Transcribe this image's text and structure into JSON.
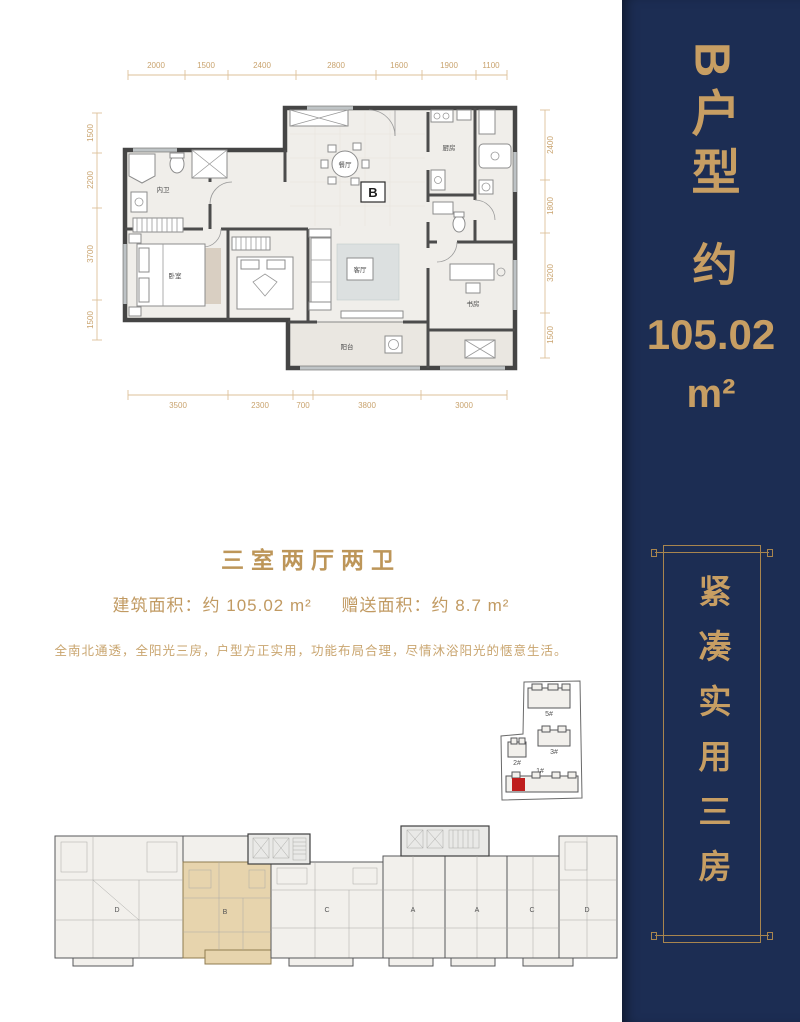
{
  "banner": {
    "line1": "B户型",
    "line2": "约",
    "area_value": "105.02",
    "area_unit": "m²",
    "tagline": "紧凑实用三房"
  },
  "summary": {
    "title": "三室两厅两卫",
    "build_area": "建筑面积：约 105.02 m²",
    "gift_area": "赠送面积：约 8.7 m²",
    "description": "全南北通透，全阳光三房，户型方正实用，功能布局合理，尽情沐浴阳光的惬意生活。"
  },
  "floor_plan": {
    "unit_marker": "B",
    "rooms": {
      "dining": "餐厅",
      "kitchen": "厨房",
      "ensuite": "内卫",
      "master": "卧室",
      "living": "客厅",
      "study": "书房",
      "balcony": "阳台"
    },
    "dims_top": [
      "2000",
      "1500",
      "2400",
      "2800",
      "1600",
      "1900",
      "1100"
    ],
    "dims_bottom": [
      "3500",
      "2300",
      "700",
      "3800",
      "3000"
    ],
    "dims_left": [
      "1500",
      "2200",
      "3700",
      "1500"
    ],
    "dims_right": [
      "2400",
      "1800",
      "3200",
      "1500"
    ]
  },
  "site_plan": {
    "labels": [
      "5#",
      "3#",
      "2#",
      "1#"
    ],
    "highlight_color": "#bf1e1e"
  },
  "building_plate": {
    "unit_labels": [
      "D",
      "B",
      "C",
      "A",
      "A",
      "C",
      "D"
    ],
    "highlight_unit": "B"
  },
  "colors": {
    "navy": "#1c2d53",
    "gold": "#c79e63",
    "plate_highlight": "#e7d4ad"
  }
}
